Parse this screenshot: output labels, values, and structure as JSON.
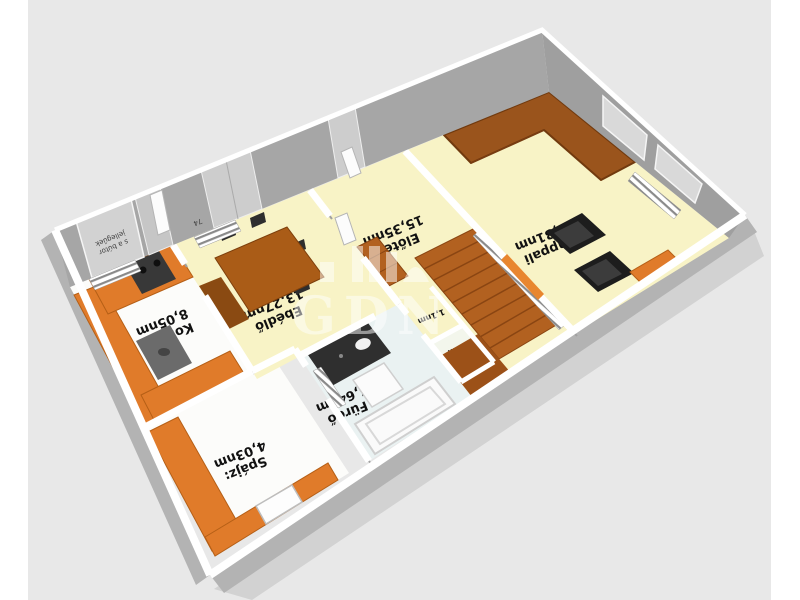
{
  "scene": {
    "background_color": "#e8e8e8",
    "margin_color": "#ffffff",
    "wall_top_color": "#ffffff",
    "wall_face_color": "#a6a6a6",
    "floor_yellow": "#f8f3c6",
    "floor_white": "#fcfcfa",
    "floor_bath": "#eaf2f2",
    "accent_orange": "#e07b2a",
    "stair_brown": "#b26120",
    "sofa_brown": "#9a541c",
    "furniture_dark": "#2e2e2e"
  },
  "rooms": [
    {
      "name": "Konyha",
      "area": "8,05nm"
    },
    {
      "name": "Spájz:",
      "area": "4,03nm"
    },
    {
      "name": "Ebédlő",
      "area": "13,27nm"
    },
    {
      "name": "Fürdő",
      "area": "5,64nm"
    },
    {
      "name": "Előtér",
      "area": "15,35nm"
    },
    {
      "name": "Nappali",
      "area": "26,31nm"
    },
    {
      "name": "1,1nm",
      "area": ""
    },
    {
      "name": "WC",
      "area": "1,3nm"
    }
  ],
  "annotations": {
    "door_width_mark": "74",
    "disclaimer_line1": "s a bútor",
    "disclaimer_line2": "jellegűek"
  },
  "watermark": {
    "text": "GDN"
  }
}
